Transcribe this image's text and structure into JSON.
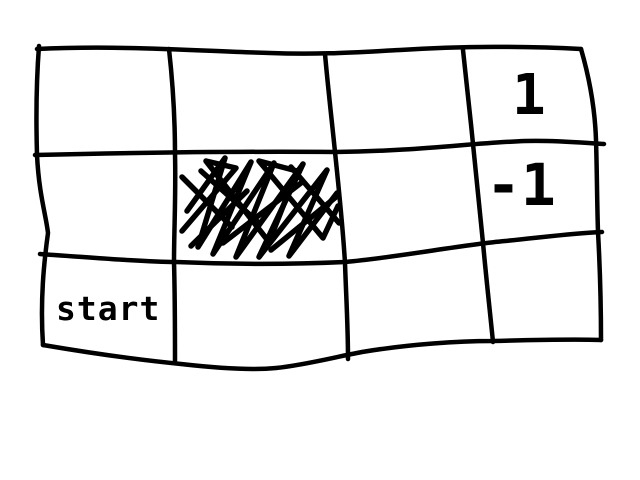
{
  "sketch": {
    "background_color": "#ffffff",
    "ink_color": "#000000"
  },
  "grid": {
    "rows": 3,
    "columns": 4,
    "scribbled_cell": {
      "row": 2,
      "column": 2
    }
  },
  "cells": {
    "reward_label": "1",
    "penalty_label": "-1",
    "start_label": "start"
  }
}
